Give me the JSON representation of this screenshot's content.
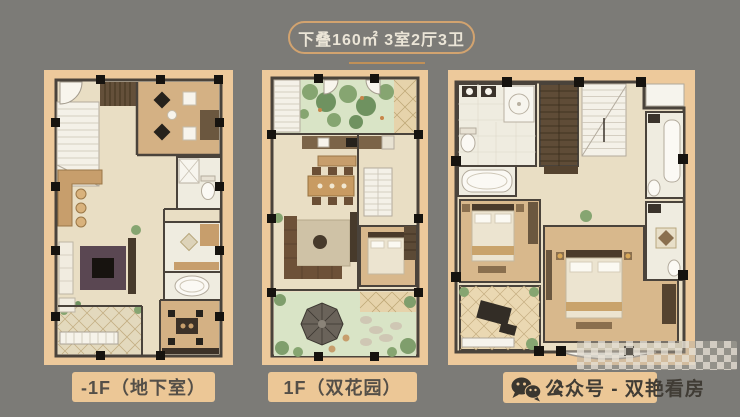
{
  "title": {
    "badge_text": "下叠160㎡  3室2厅3卫"
  },
  "floor_plans": [
    {
      "id": "basement",
      "label": "-1F（地下室）"
    },
    {
      "id": "floor-1",
      "label": "1F（双花园）"
    },
    {
      "id": "floor-2",
      "label_visible_fragment": "2"
    }
  ],
  "watermark": {
    "icon": "wechat-icon",
    "text": "公众号 - 双艳看房"
  },
  "colors": {
    "background": "#7c7b77",
    "panel_bg": "#edc99b",
    "badge_border": "#d2a36f",
    "badge_text_color": "#ebe5d7",
    "divider": "#c09058",
    "label_bg": "#ecc796",
    "label_text_color": "#544f48",
    "watermark_text_color": "#403c35"
  }
}
